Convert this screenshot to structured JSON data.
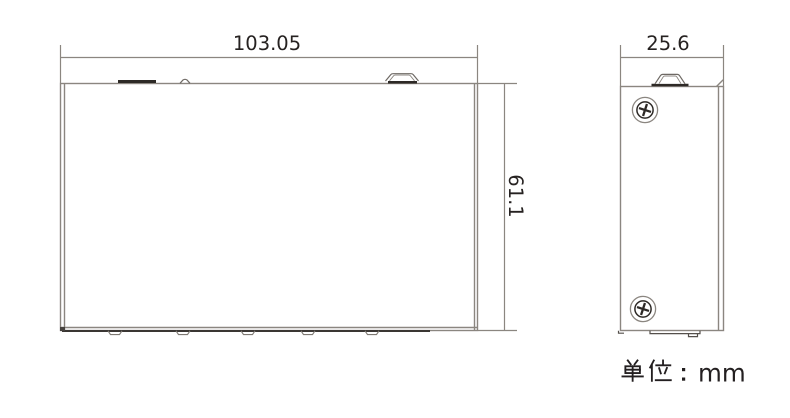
{
  "drawing": {
    "views": {
      "front": {
        "width_label": "103.05",
        "height_label": "61.1"
      },
      "side": {
        "depth_label": "25.6"
      }
    },
    "unit_note": {
      "full_text": "单位：mm",
      "cjk_prefix": "单位",
      "colon": "：",
      "unit": "mm"
    },
    "colors": {
      "outline_gray": "#8b8680",
      "dark_detail": "#2d2926",
      "text": "#262221",
      "background": "#ffffff"
    }
  }
}
